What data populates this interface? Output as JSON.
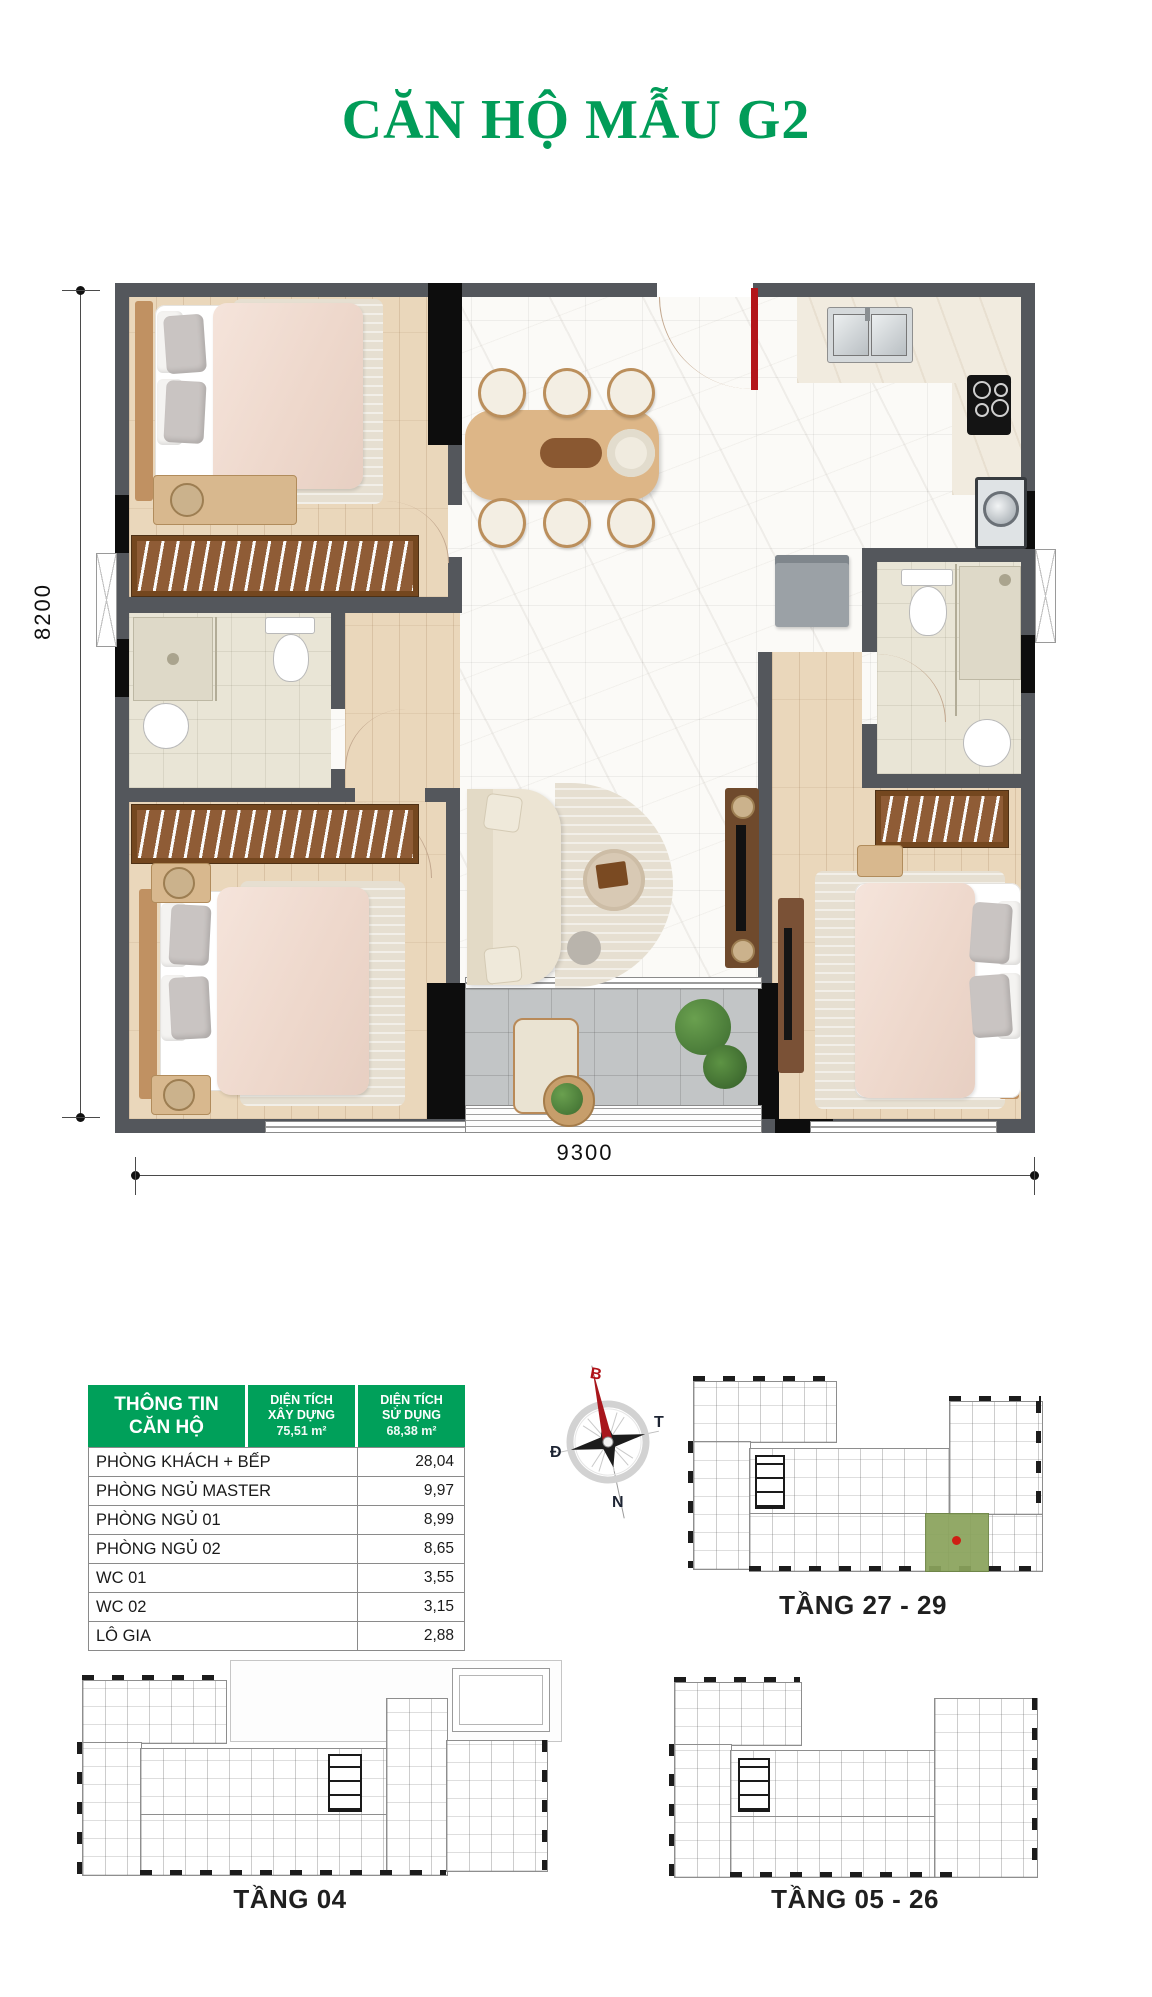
{
  "title": "CĂN HỘ MẪU G2",
  "plan_dimensions": {
    "width_label": "9300",
    "height_label": "8200"
  },
  "info_table": {
    "header": {
      "col1_line1": "THÔNG TIN",
      "col1_line2": "CĂN HỘ",
      "col2_line1": "DIỆN TÍCH",
      "col2_line2": "XÂY DỰNG",
      "col2_area": "75,51 m²",
      "col3_line1": "DIỆN TÍCH",
      "col3_line2": "SỬ DỤNG",
      "col3_area": "68,38 m²"
    },
    "rows": [
      {
        "label": "PHÒNG KHÁCH + BẾP",
        "value": "28,04"
      },
      {
        "label": "PHÒNG NGỦ MASTER",
        "value": "9,97"
      },
      {
        "label": "PHÒNG NGỦ 01",
        "value": "8,99"
      },
      {
        "label": "PHÒNG NGỦ 02",
        "value": "8,65"
      },
      {
        "label": "WC 01",
        "value": "3,55"
      },
      {
        "label": "WC 02",
        "value": "3,15"
      },
      {
        "label": "LÔ GIA",
        "value": "2,88"
      }
    ]
  },
  "compass": {
    "north": "B",
    "south": "N",
    "east": "Đ",
    "west": "T"
  },
  "floor_plans": [
    {
      "label": "TẦNG 27 - 29"
    },
    {
      "label": "TẦNG 04"
    },
    {
      "label": "TẦNG 05 - 26"
    }
  ],
  "colors": {
    "brand_green": "#00A05A",
    "door_red": "#B3151A",
    "wall_gray": "#54575C",
    "unit_highlight_green": "#8AA35C",
    "unit_dot_red": "#CF1F14"
  }
}
